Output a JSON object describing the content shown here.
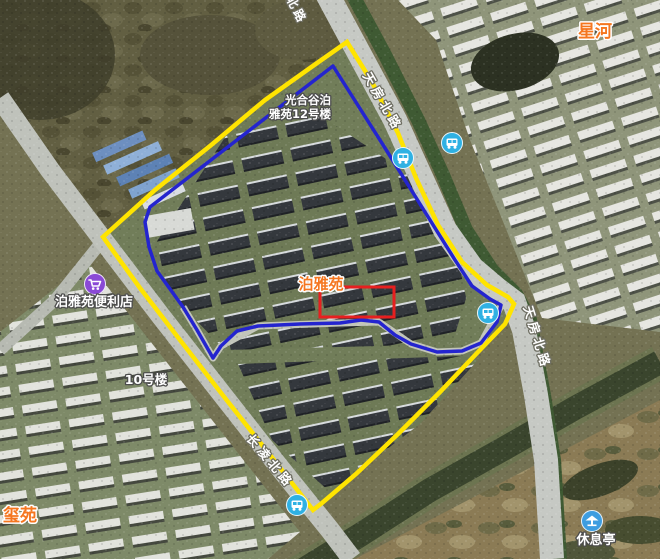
{
  "map": {
    "labels": {
      "residential": [
        {
          "text": "星河"
        },
        {
          "text": "泊雅苑"
        },
        {
          "text": "玺苑"
        }
      ],
      "poi": [
        {
          "text": "泊雅苑便利店"
        },
        {
          "text": "10号楼"
        },
        {
          "text": "休息亭"
        }
      ],
      "building": {
        "line1": "光合谷泊",
        "line2": "雅苑12号楼"
      },
      "roads": [
        {
          "text": "北路"
        },
        {
          "text": "天房北路"
        },
        {
          "text": "天房北路"
        },
        {
          "text": "长凌北路"
        }
      ]
    },
    "colors": {
      "boundary_yellow": "#ffe400",
      "boundary_blue": "#2424cf",
      "highlight_red": "#e71f1f",
      "label_orange": "#f5761f",
      "store_icon_purple": "#8a49d6",
      "transit_icon_blue": "#2fb1e3",
      "pavilion_icon_blue": "#3e9de0"
    },
    "icons": [
      {
        "name": "shopping-cart-icon"
      },
      {
        "name": "bus-stop-icon"
      },
      {
        "name": "pavilion-icon"
      }
    ]
  }
}
